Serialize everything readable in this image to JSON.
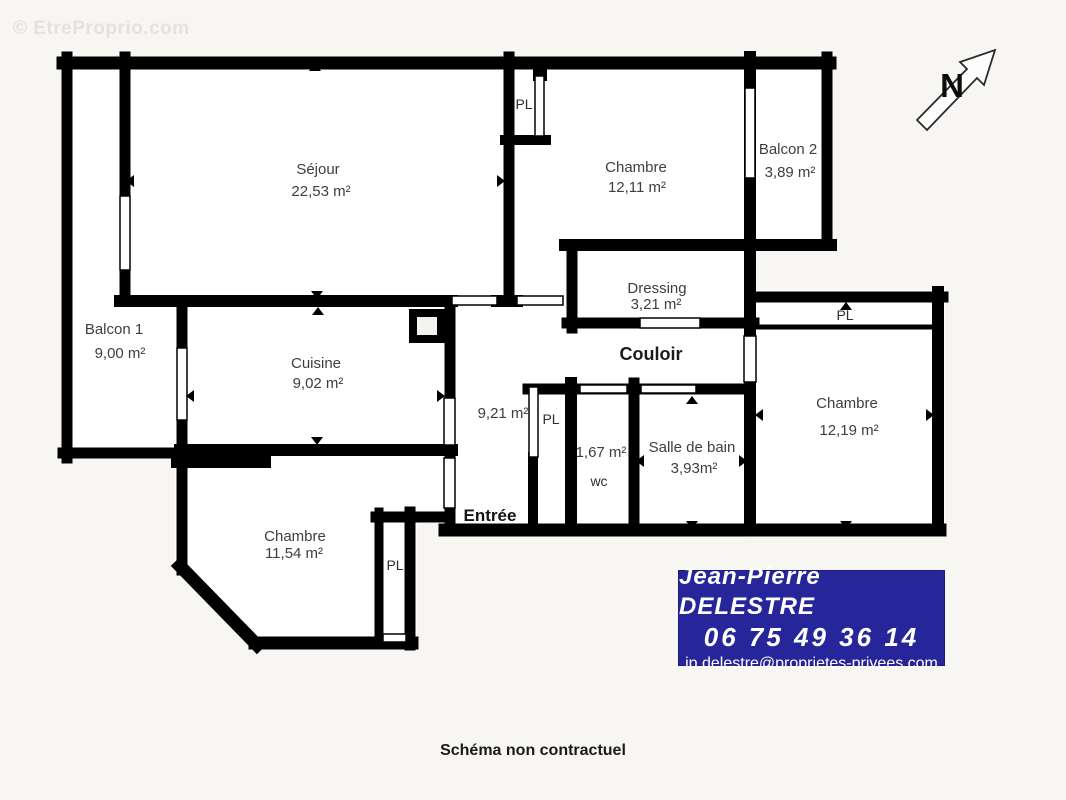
{
  "watermark": "© EtreProprio.com",
  "compass": {
    "label": "N"
  },
  "rooms": {
    "sejour": {
      "name": "Séjour",
      "area": "22,53 m²"
    },
    "chambre1": {
      "name": "Chambre",
      "area": "12,11 m²"
    },
    "balcon2": {
      "name": "Balcon 2",
      "area": "3,89 m²"
    },
    "dressing": {
      "name": "Dressing",
      "area": "3,21 m²"
    },
    "balcon1": {
      "name": "Balcon 1",
      "area": "9,00 m²"
    },
    "cuisine": {
      "name": "Cuisine",
      "area": "9,02 m²"
    },
    "couloir": {
      "name": "Couloir",
      "area": "9,21 m²"
    },
    "entree": {
      "name": "Entrée"
    },
    "wc": {
      "name": "wc",
      "area": "1,67 m²"
    },
    "salle_de_bain": {
      "name": "Salle de bain",
      "area": "3,93m²"
    },
    "chambre2": {
      "name": "Chambre",
      "area": "12,19 m²"
    },
    "chambre3": {
      "name": "Chambre",
      "area": "11,54 m²"
    }
  },
  "closet_label": "PL",
  "agent": {
    "name": "Jean-Pierre DELESTRE",
    "phone": "06 75 49 36 14",
    "email": "jp.delestre@proprietes-privees.com"
  },
  "footer": {
    "disclaimer": "Schéma non contractuel"
  },
  "colors": {
    "background": "#f7f6f2",
    "wall": "#000000",
    "room_fill": "#ffffff",
    "label": "#3e3e3e",
    "banner_bg": "#26269a",
    "banner_text": "#ffffff",
    "watermark": "#e4e2dd"
  }
}
